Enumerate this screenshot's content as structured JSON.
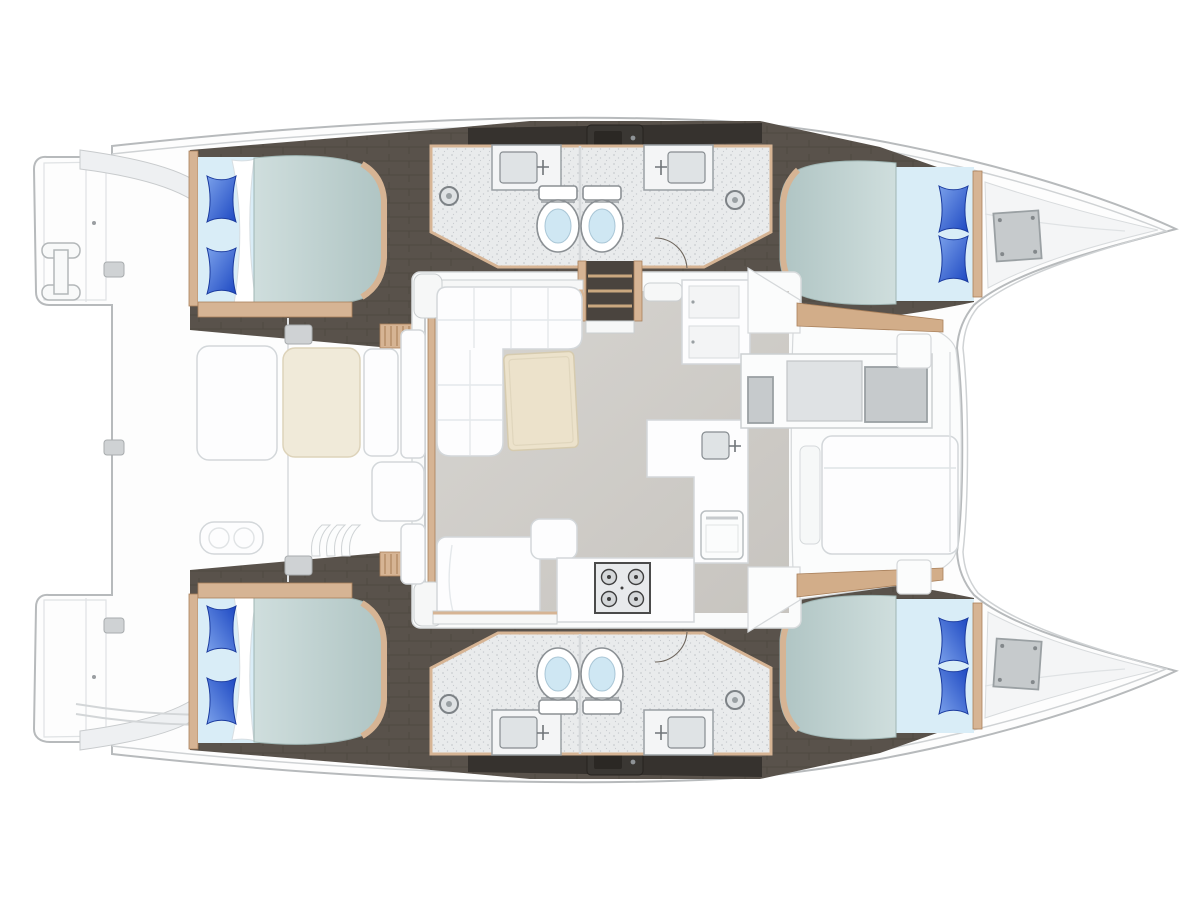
{
  "canvas": {
    "width": "1200",
    "height": "900",
    "viewBox": "0 0 1200 900"
  },
  "colors": {
    "background": "#ffffff",
    "hull_fill": "#fdfdfd",
    "hull_stroke": "#b7babc",
    "inner_line": "#cfd2d4",
    "panel_line": "#dfe2e4",
    "deck_shadow": "#eef0f2",
    "floor_dark": "#59524b",
    "floor_dark_line": "#504942",
    "roof_dark": "#36322e",
    "pod_dark": "#3a3733",
    "pod_knob": "#8f9396",
    "wood_trim": "#d6b494",
    "wood_walk": "#d2ad89",
    "wood_dark": "#a9805b",
    "bath_floor": "#e9ebec",
    "bath_speckle": "#c9ccd0",
    "wall_gray": "#9aa0a4",
    "fixture_stroke": "#8b9094",
    "toilet_bowl": "#cfe7f3",
    "basin_gray": "#dfe3e5",
    "salon_floor_light": "#d7d5d1",
    "salon_floor_dark": "#c7c4bf",
    "furn_white": "#fdfdfe",
    "furn_stroke": "#d3d7da",
    "quilt_line": "#e4e8eb",
    "table_beige": "#ece2cb",
    "table_stroke": "#d6cbaf",
    "cream_seat": "#f0ead9",
    "mattress_light": "#cfdedd",
    "mattress_dark": "#afc4c3",
    "mattress_stroke": "#9fb5b3",
    "bed_base": "#d9edf7",
    "sheet_white": "#ffffff",
    "sheet_stroke": "#d7dee2",
    "pillow_light": "#7aa0ea",
    "pillow_dark": "#1d48c2",
    "pillow_stroke": "#1a3a9e",
    "hatch_gray": "#c6cacc",
    "hatch_mid": "#dfe2e4",
    "hatch_stroke": "#9aa0a3",
    "stove_face": "#e8eaec",
    "stove_stroke": "#4b4b4b",
    "burner": "#d4d7d9",
    "burner_stroke": "#3e3e3e",
    "cleat_gray": "#cfd2d4",
    "cleat_stroke": "#a8acae",
    "wall_white": "#f6f7f7",
    "wall_stroke": "#cbcfd1",
    "stair_well": "#4a443e",
    "stair_tread": "#caa87f"
  },
  "scene": {
    "type": "catamaran-floor-plan",
    "orientation": "bow-right",
    "hulls": 2,
    "cabins": 4,
    "double_berths": 4,
    "pillows": 8,
    "bathrooms": 4,
    "toilets": 4,
    "bathroom_sinks": 4,
    "shower_drains": 4,
    "staircases": 4,
    "salon": {
      "l_sofa": 1,
      "coffee_table": 1,
      "daybed": 1,
      "ottoman": 1,
      "galley_counter": 1,
      "galley_sink": 1,
      "stove_burners": 4,
      "fridge_cabinet": 1,
      "oven": 1
    },
    "cockpit": {
      "bench_seats": 5,
      "cockpit_table": 1,
      "swim_ladder": 1,
      "transom_platforms": 2,
      "cleats": 5
    },
    "foredeck": {
      "sun_lounger": 1,
      "deck_hatches": 3,
      "bow_lockers": 2
    }
  }
}
